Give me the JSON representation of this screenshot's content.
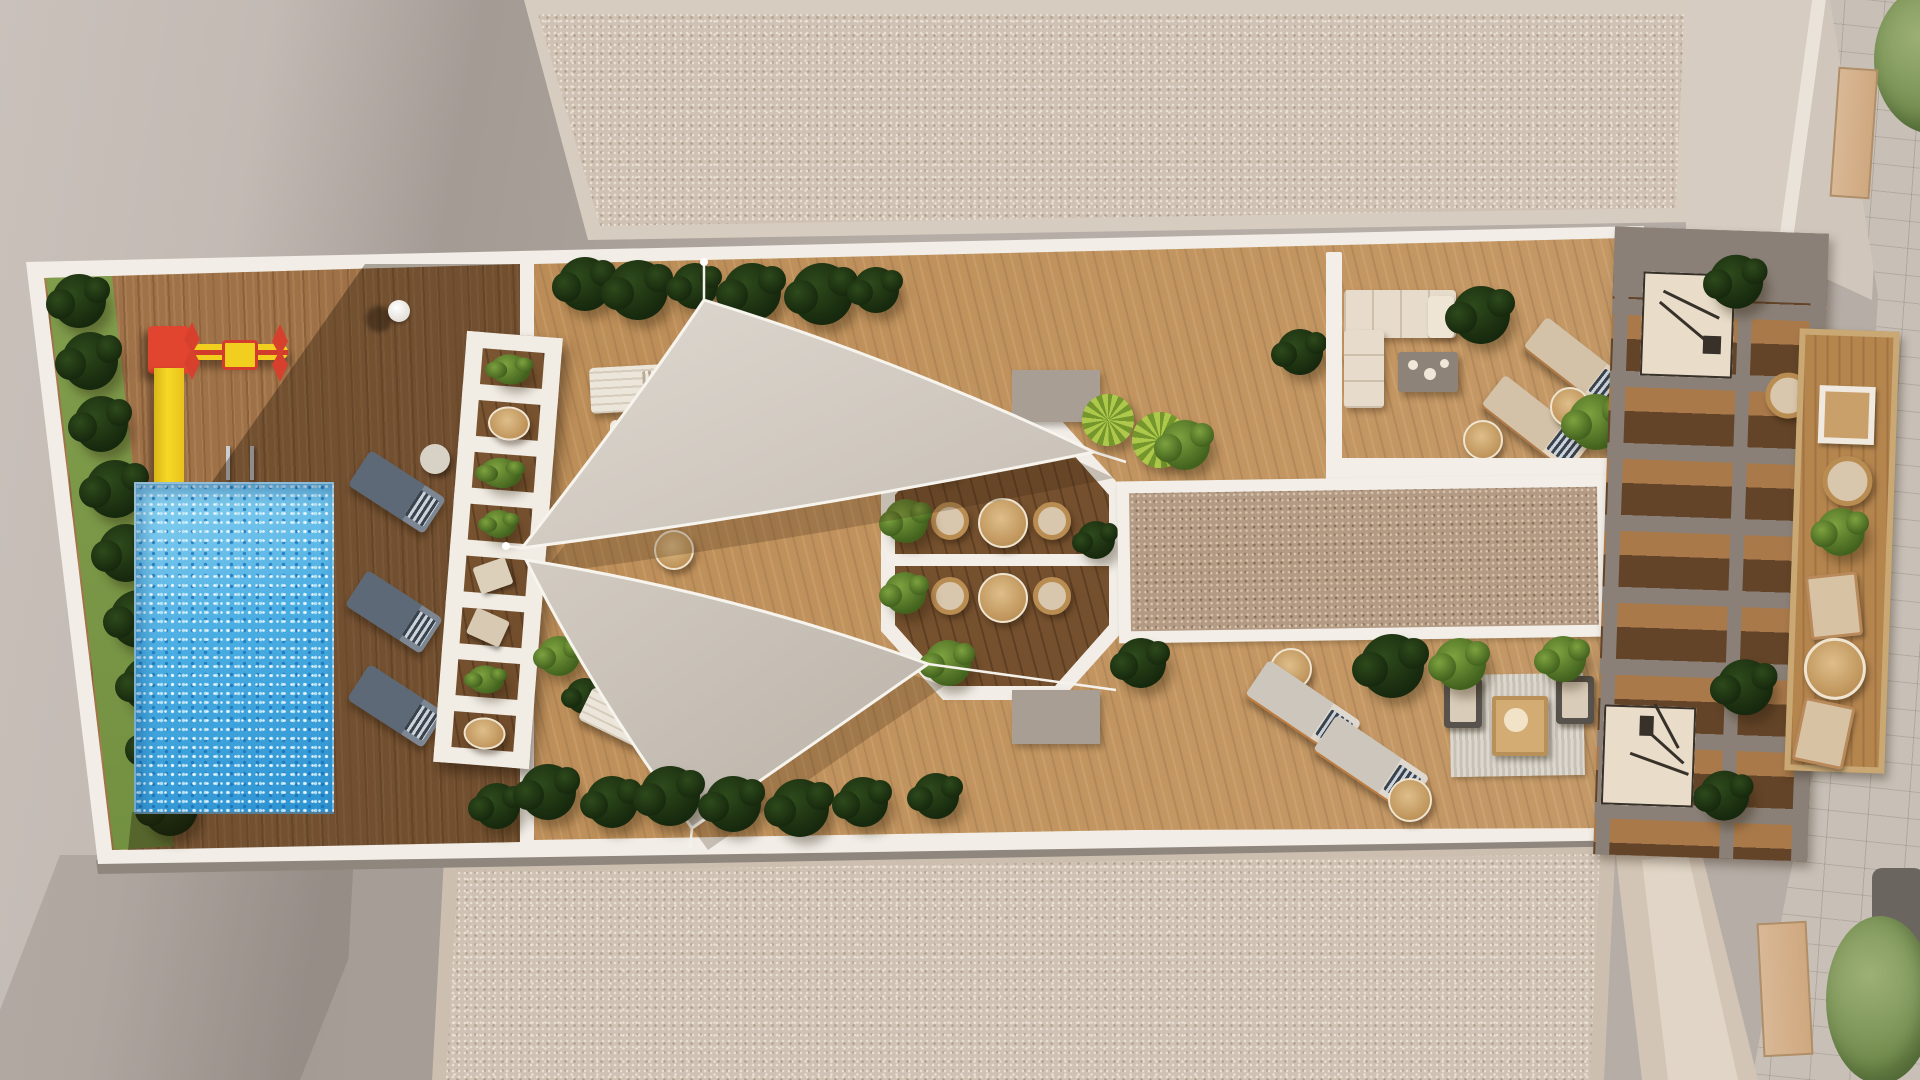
{
  "scene": {
    "title": "Rooftop amenity terrace — aerial 3D architectural render",
    "areas": {
      "pool_terrace": {
        "label": "Pool terrace with kids playground"
      },
      "playground": {
        "label": "Kids playground: slide and carousel"
      },
      "pool": {
        "label": "Swimming pool"
      },
      "sun_deck": {
        "label": "Sun deck with two triangular shade sails"
      },
      "white_pergola": {
        "label": "White slatted pergola with planters and seats"
      },
      "dining_octagon": {
        "label": "Octagonal dining pavilion, 2 tables, 4 rattan chairs"
      },
      "gravel_roof_top": {
        "label": "Upper gravel roof field"
      },
      "gravel_roof_bottom": {
        "label": "Lower gravel roof field"
      },
      "gravel_strip": {
        "label": "Central gravel skylight strip"
      },
      "lounge_deck": {
        "label": "Lounge deck: corner sofa, loungers, rug seating"
      },
      "pergola": {
        "label": "Gray slatted pergola with stairs"
      },
      "side_terrace": {
        "label": "Rattan lounge side terrace"
      },
      "street": {
        "label": "Stone-paved street edge with trees and awnings"
      }
    },
    "counts": {
      "shade_sails": 2,
      "dining_tables": 2,
      "dining_chairs": 4,
      "pool_loungers": 3,
      "white_loungers": 3,
      "beige_loungers": 2,
      "gray_loungers": 2,
      "rattan_loungers": 2,
      "staircases": 2
    },
    "palette": {
      "ground": "#b6ada6",
      "ground_shadow": "#a19992",
      "walkway_white": "#f2eee7",
      "gravel_light": "#cfc2b4",
      "gravel_brown": "#b39a84",
      "wood_sun": "#c79d6d",
      "wood_warm": "#b5854e",
      "wood_shadow": "#6f4b2a",
      "pool_water": "#4aade2",
      "pool_sparkle": "#bfe9fa",
      "hedge_grass": "#7d9c49",
      "bush_dark": "#1c3110",
      "bush_light": "#5f8030",
      "palm_green": "#aec84b",
      "sail": "#d5cec5",
      "playground_red": "#e2452f",
      "playground_yellow": "#f2cf1f",
      "lounger_slate": "#5d6976",
      "cushion_beige": "#dcccb4",
      "rattan": "#b98c52",
      "pergola_gray": "#8b8077",
      "stair_beige": "#e9ddc9",
      "stone_street": "#c8c0b7",
      "rug": "#d6d2c9"
    }
  }
}
